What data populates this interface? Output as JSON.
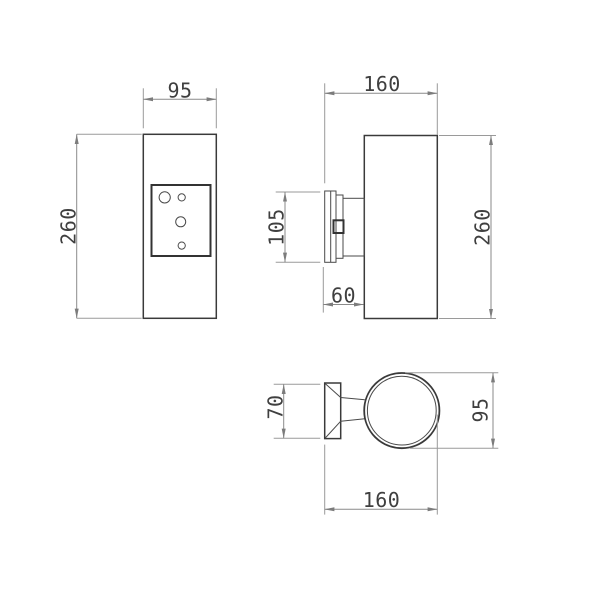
{
  "drawing": {
    "dimensions": {
      "front_width": "95",
      "front_height": "260",
      "side_width": "160",
      "side_bracket_height": "105",
      "side_bracket_depth": "60",
      "side_height": "260",
      "top_bracket_width": "70",
      "top_diameter": "95",
      "top_width": "160"
    },
    "colors": {
      "object_line": "#3a3a3a",
      "dimension_line": "#8a8a8a",
      "text": "#3f3f3f",
      "background": "#ffffff"
    }
  }
}
